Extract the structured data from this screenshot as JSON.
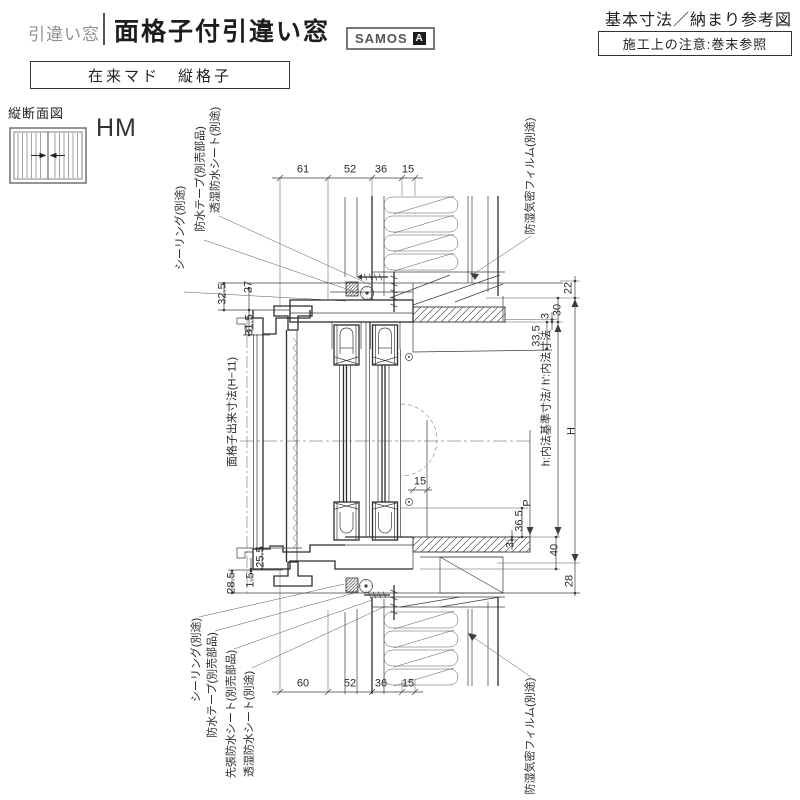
{
  "header": {
    "category": "引違い窓",
    "title": "面格子付引違い窓",
    "brand": "SAMOS",
    "brand_mark": "A",
    "right_title": "基本寸法／納まり参考図",
    "note": "施工上の注意:巻末参照",
    "subtype": "在来マド　縦格子"
  },
  "section": {
    "label": "縦断面図",
    "code": "HM",
    "icon": "sliding-window-lattice-icon"
  },
  "colors": {
    "line": "#3d3d3d",
    "text": "#222222",
    "muted": "#8f8f8f"
  },
  "drawing": {
    "dimensions": [
      {
        "t": "61",
        "x": 303,
        "y": 170
      },
      {
        "t": "52",
        "x": 350,
        "y": 170
      },
      {
        "t": "36",
        "x": 381,
        "y": 170
      },
      {
        "t": "15",
        "x": 408,
        "y": 170
      },
      {
        "t": "60",
        "x": 303,
        "y": 684
      },
      {
        "t": "52",
        "x": 350,
        "y": 684
      },
      {
        "t": "36",
        "x": 381,
        "y": 684
      },
      {
        "t": "15",
        "x": 408,
        "y": 684
      },
      {
        "t": "15",
        "x": 420,
        "y": 482
      },
      {
        "t": "32.5",
        "x": 223,
        "y": 294,
        "v": 1
      },
      {
        "t": "27",
        "x": 249,
        "y": 287,
        "v": 1
      },
      {
        "t": "31.5",
        "x": 250,
        "y": 325,
        "v": 1
      },
      {
        "t": "25.5",
        "x": 261,
        "y": 557,
        "v": 1
      },
      {
        "t": "1.5",
        "x": 251,
        "y": 580,
        "v": 1
      },
      {
        "t": "28.5",
        "x": 232,
        "y": 583,
        "v": 1
      },
      {
        "t": "22",
        "x": 569,
        "y": 288,
        "v": 1
      },
      {
        "t": "30",
        "x": 558,
        "y": 310,
        "v": 1
      },
      {
        "t": "3",
        "x": 546,
        "y": 316,
        "v": 1
      },
      {
        "t": "33.5",
        "x": 537,
        "y": 336,
        "v": 1
      },
      {
        "t": "H",
        "x": 572,
        "y": 431,
        "v": 1
      },
      {
        "t": "P",
        "x": 528,
        "y": 503,
        "v": 1
      },
      {
        "t": "36.5",
        "x": 520,
        "y": 521,
        "v": 1
      },
      {
        "t": "3",
        "x": 511,
        "y": 545,
        "v": 1
      },
      {
        "t": "40",
        "x": 555,
        "y": 550,
        "v": 1
      },
      {
        "t": "28",
        "x": 570,
        "y": 581,
        "v": 1
      },
      {
        "t": "面格子出来寸法(H−11)",
        "x": 233,
        "y": 412,
        "v": 1
      },
      {
        "t": "h:内法基準寸法/ h′:内法寸法",
        "x": 547,
        "y": 398,
        "v": 1
      }
    ],
    "annotations": [
      {
        "t": "シーリング(別途)",
        "x": 181,
        "y": 228,
        "v": 1
      },
      {
        "t": "防水テープ(別売部品)",
        "x": 201,
        "y": 179,
        "v": 1
      },
      {
        "t": "透湿防水シート(別途)",
        "x": 216,
        "y": 160,
        "v": 1
      },
      {
        "t": "防湿気密フィルム(別途)",
        "x": 531,
        "y": 176,
        "v": 1
      },
      {
        "t": "シーリング(別途)",
        "x": 197,
        "y": 660,
        "v": 1
      },
      {
        "t": "防水テープ(別売部品)",
        "x": 213,
        "y": 685,
        "v": 1
      },
      {
        "t": "先張防水シート(別売部品)",
        "x": 232,
        "y": 714,
        "v": 1
      },
      {
        "t": "透湿防水シート(別途)",
        "x": 250,
        "y": 724,
        "v": 1
      },
      {
        "t": "防湿気密フィルム(別途)",
        "x": 531,
        "y": 736,
        "v": 1
      }
    ]
  }
}
